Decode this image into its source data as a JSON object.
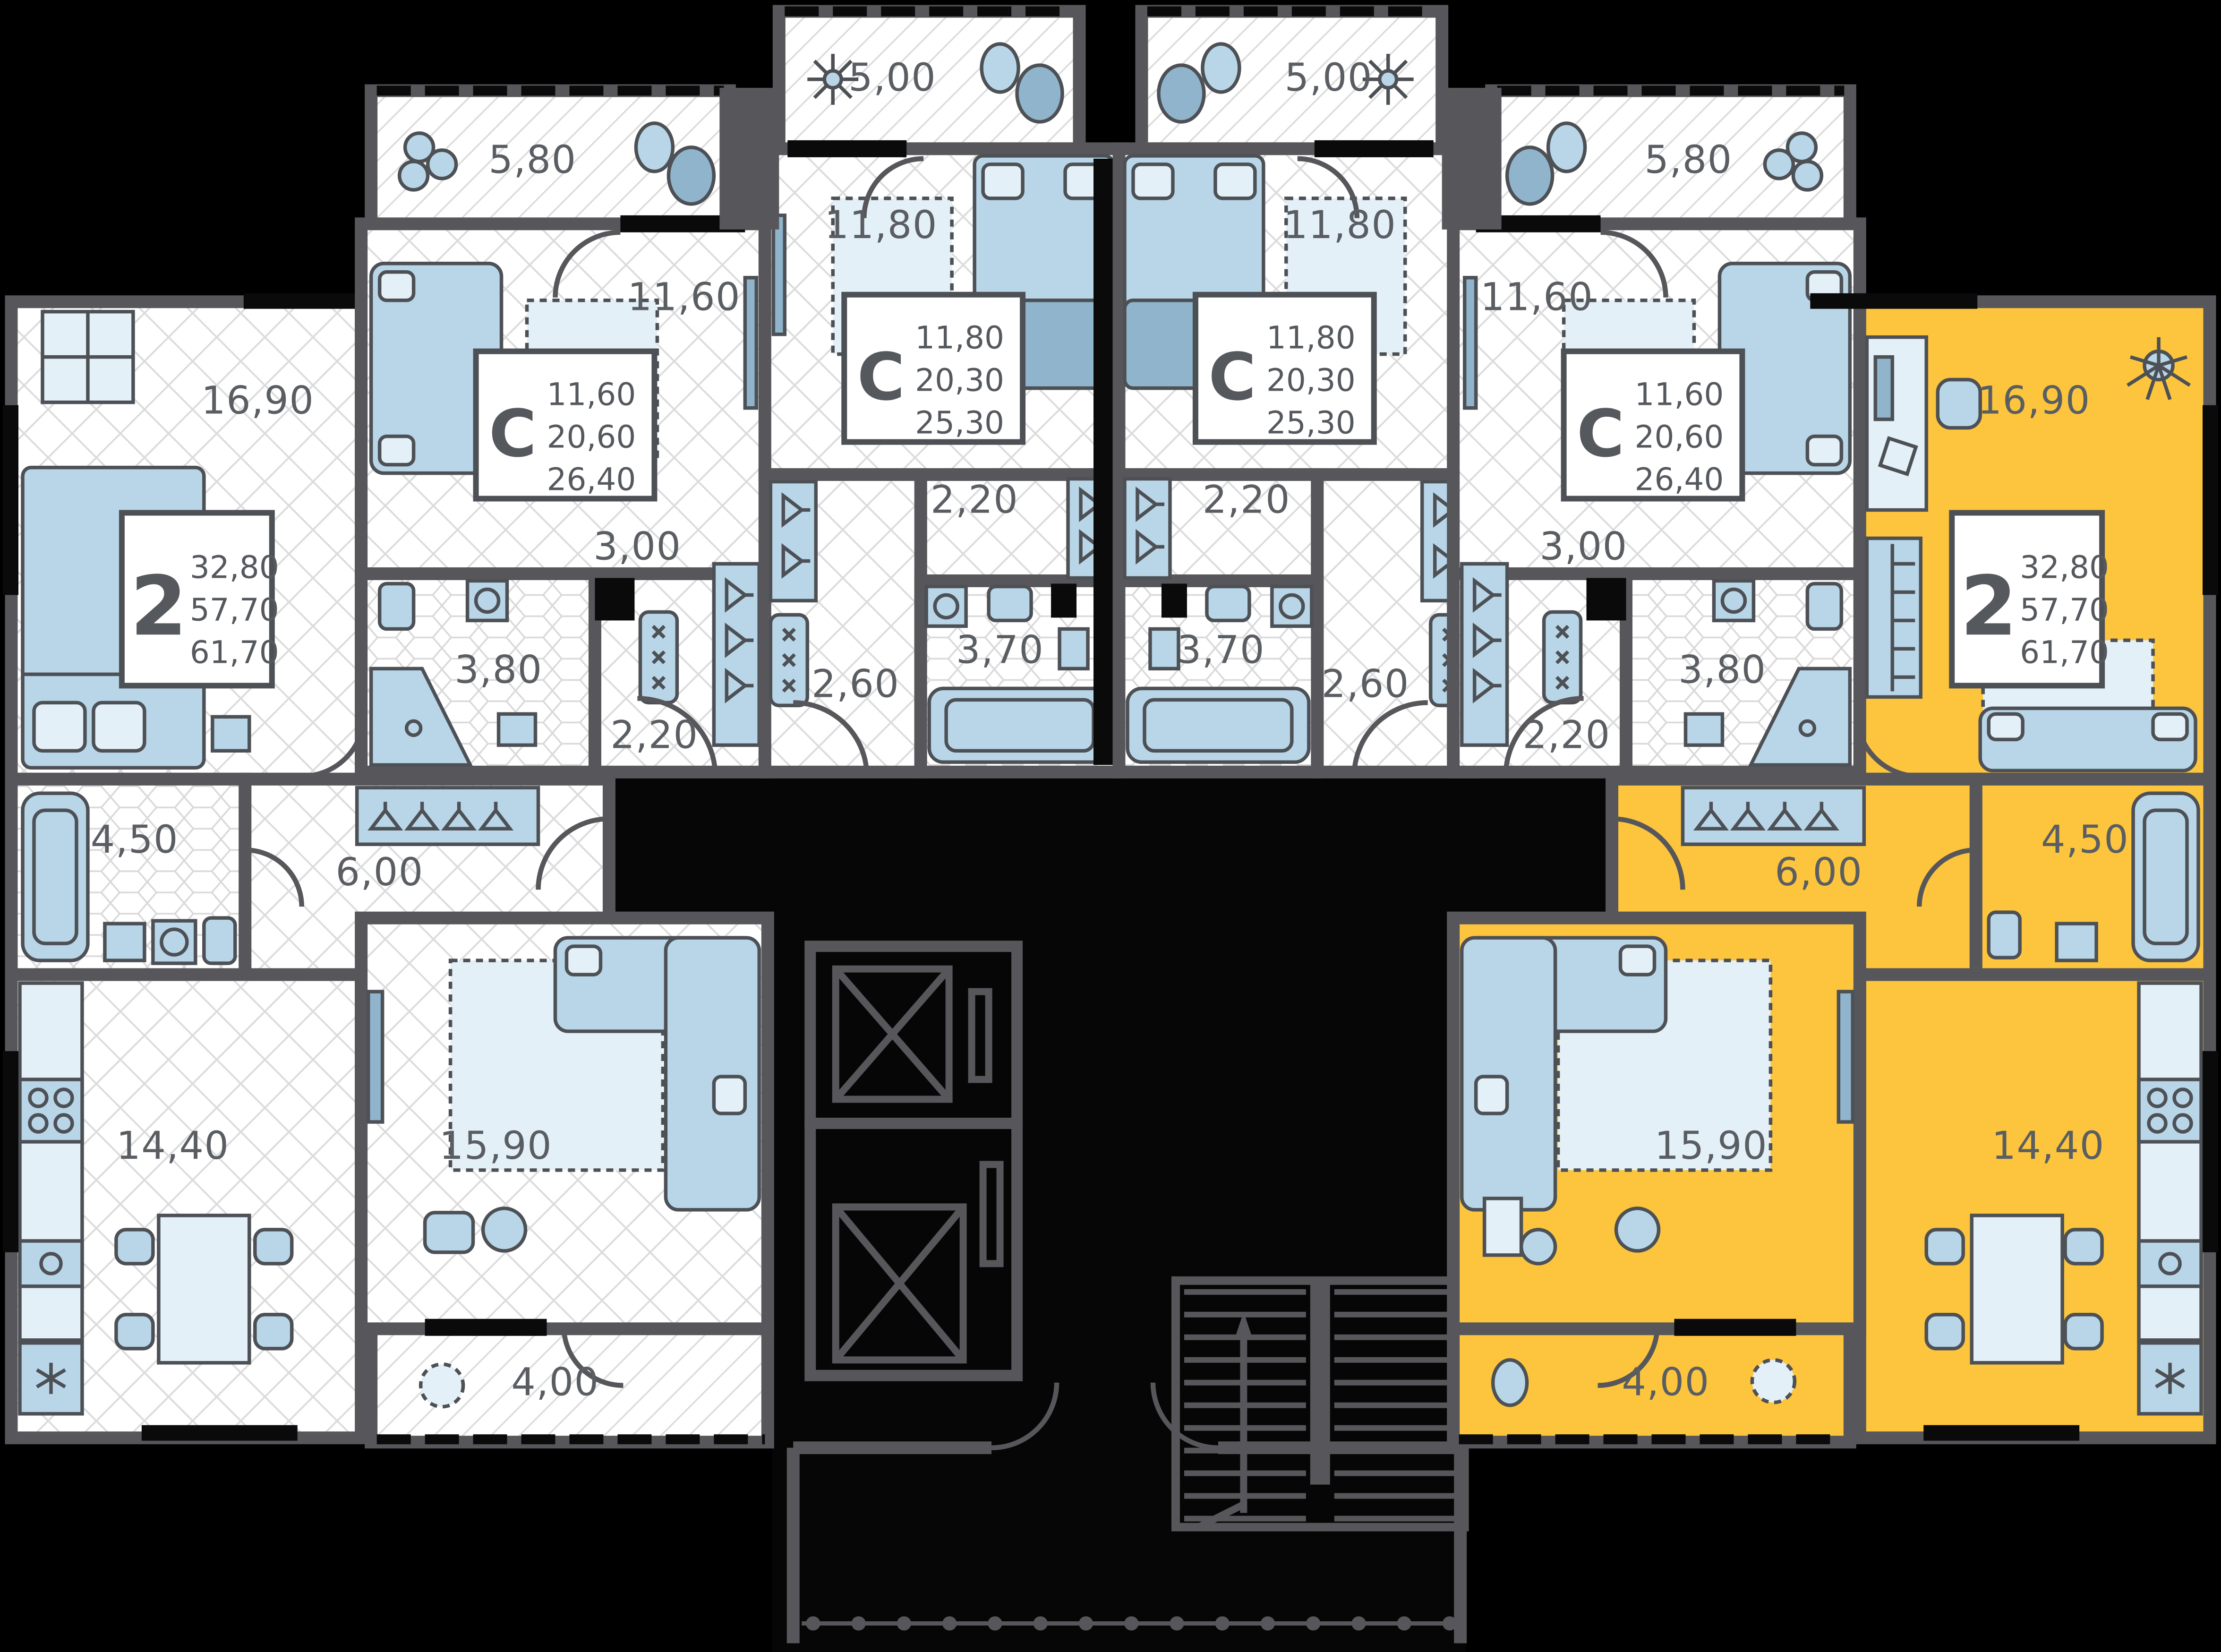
{
  "plan": {
    "colors": {
      "background": "#000000",
      "wall": "#57575b",
      "floor": "#ffffff",
      "floor_lines": "#d9d9d9",
      "furniture": "#b9d6e8",
      "furniture_accent": "#8fb4cc",
      "highlight": "#fcc53d",
      "label_text": "#5a5e63"
    },
    "icons": {
      "elevator": "crossed-box-icon",
      "stairs": "treads-arrow-icon",
      "plant": "cloud-plant-icon",
      "wardrobe": "hangers-icon",
      "fridge": "snowflake-icon",
      "washer": "wave-drum-icon"
    },
    "apartments": [
      {
        "id": "apt-2room-left",
        "type_label": "2",
        "highlighted": false,
        "areas": {
          "living": "32,80",
          "apartment": "57,70",
          "total": "61,70"
        },
        "rooms": [
          {
            "name": "bedroom",
            "area": "16,90"
          },
          {
            "name": "bathroom",
            "area": "4,50"
          },
          {
            "name": "hallway",
            "area": "6,00"
          },
          {
            "name": "kitchen-dining",
            "area": "14,40"
          },
          {
            "name": "living-room",
            "area": "15,90"
          },
          {
            "name": "balcony",
            "area": "4,00"
          }
        ]
      },
      {
        "id": "studio-1",
        "type_label": "С",
        "highlighted": false,
        "areas": {
          "living": "11,60",
          "apartment": "20,60",
          "total": "26,40"
        },
        "rooms": [
          {
            "name": "room",
            "area": "11,60"
          },
          {
            "name": "hallway",
            "area": "3,00"
          },
          {
            "name": "bathroom",
            "area": "3,80"
          },
          {
            "name": "wardrobe",
            "area": "2,20"
          },
          {
            "name": "balcony",
            "area": "5,80"
          }
        ]
      },
      {
        "id": "studio-2",
        "type_label": "С",
        "highlighted": false,
        "areas": {
          "living": "11,80",
          "apartment": "20,30",
          "total": "25,30"
        },
        "rooms": [
          {
            "name": "room",
            "area": "11,80"
          },
          {
            "name": "wardrobe",
            "area": "2,20"
          },
          {
            "name": "hallway",
            "area": "2,60"
          },
          {
            "name": "bathroom",
            "area": "3,70"
          },
          {
            "name": "balcony",
            "area": "5,00"
          }
        ]
      },
      {
        "id": "studio-3",
        "type_label": "С",
        "highlighted": false,
        "areas": {
          "living": "11,80",
          "apartment": "20,30",
          "total": "25,30"
        },
        "rooms": [
          {
            "name": "room",
            "area": "11,80"
          },
          {
            "name": "wardrobe",
            "area": "2,20"
          },
          {
            "name": "hallway",
            "area": "2,60"
          },
          {
            "name": "bathroom",
            "area": "3,70"
          },
          {
            "name": "balcony",
            "area": "5,00"
          }
        ]
      },
      {
        "id": "studio-4",
        "type_label": "С",
        "highlighted": false,
        "areas": {
          "living": "11,60",
          "apartment": "20,60",
          "total": "26,40"
        },
        "rooms": [
          {
            "name": "room",
            "area": "11,60"
          },
          {
            "name": "hallway",
            "area": "3,00"
          },
          {
            "name": "bathroom",
            "area": "3,80"
          },
          {
            "name": "wardrobe",
            "area": "2,20"
          },
          {
            "name": "balcony",
            "area": "5,80"
          }
        ]
      },
      {
        "id": "apt-2room-right",
        "type_label": "2",
        "highlighted": true,
        "areas": {
          "living": "32,80",
          "apartment": "57,70",
          "total": "61,70"
        },
        "rooms": [
          {
            "name": "room",
            "area": "16,90"
          },
          {
            "name": "bathroom",
            "area": "4,50"
          },
          {
            "name": "hallway",
            "area": "6,00"
          },
          {
            "name": "kitchen-dining",
            "area": "14,40"
          },
          {
            "name": "living-room",
            "area": "15,90"
          },
          {
            "name": "balcony",
            "area": "4,00"
          }
        ]
      }
    ]
  }
}
